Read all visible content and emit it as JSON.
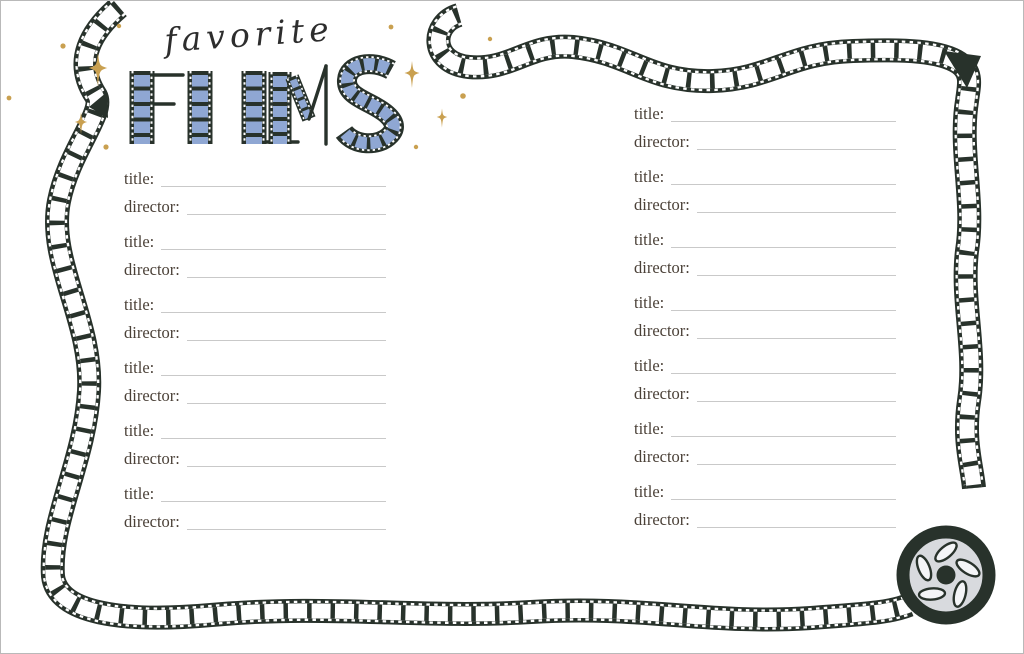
{
  "header": {
    "script_title": "favorite",
    "block_title": "FILMS"
  },
  "field_labels": {
    "title": "title:",
    "director": "director:"
  },
  "columns": {
    "left_count": 6,
    "right_count": 7
  },
  "decorations": {
    "border": "hand-drawn-film-strip-border",
    "reel": "film-reel-icon",
    "sparkles": "four-point-star-sparkles",
    "letters": "film-strip-letters"
  },
  "colors": {
    "film_dark": "#28322b",
    "frame_blue": "#8fa7d3",
    "gold": "#c9a050",
    "label_text": "#4b4138",
    "line": "#c9c9c9",
    "reel_inner": "#d8dade"
  }
}
